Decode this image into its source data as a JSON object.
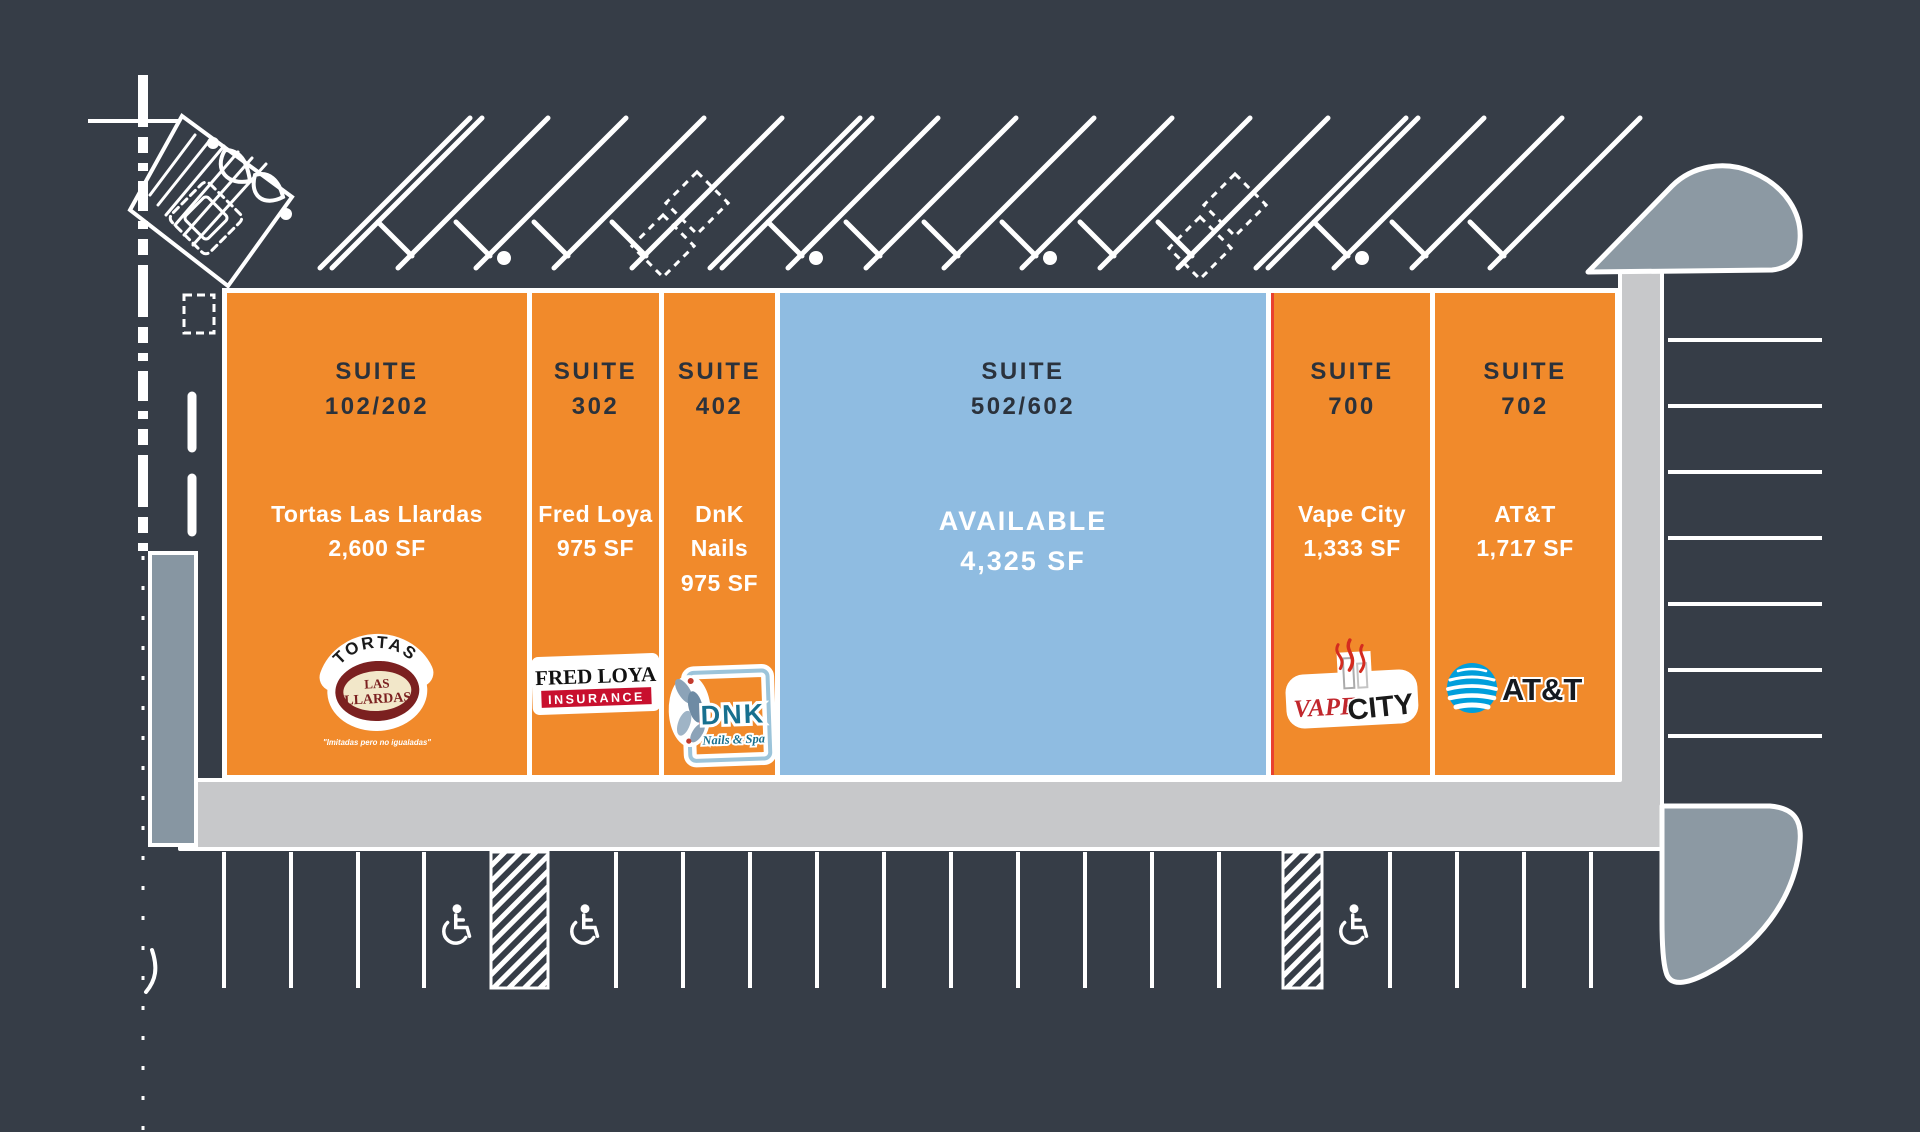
{
  "labels": {
    "suite": "SUITE"
  },
  "suites": [
    {
      "number": "102/202",
      "tenant": "Tortas Las Llardas",
      "area": "2,600 SF",
      "status": "leased"
    },
    {
      "number": "302",
      "tenant": "Fred Loya",
      "area": "975 SF",
      "status": "leased"
    },
    {
      "number": "402",
      "tenant": "DnK Nails",
      "area": "975 SF",
      "status": "leased"
    },
    {
      "number": "502/602",
      "tenant": "AVAILABLE",
      "area": "4,325 SF",
      "status": "available"
    },
    {
      "number": "700",
      "tenant": "Vape City",
      "area": "1,333 SF",
      "status": "leased"
    },
    {
      "number": "702",
      "tenant": "AT&T",
      "area": "1,717 SF",
      "status": "leased"
    }
  ],
  "logos": {
    "tortas": {
      "top": "TORTAS",
      "line1": "LAS",
      "line2": "LLARDAS",
      "tagline": "\"Imitadas pero no igualadas\""
    },
    "fred_loya": {
      "name": "FRED LOYA",
      "sub": "INSURANCE"
    },
    "dnk": {
      "name": "DNK",
      "sub": "Nails & Spa"
    },
    "vape": {
      "word1": "VAPE",
      "word2": "CITY"
    },
    "att": {
      "name": "AT&T"
    }
  },
  "colors": {
    "background": "#363D47",
    "leased_fill": "#F18A2B",
    "available_fill": "#8FBCE1",
    "suite_number_text": "#2B323C",
    "tenant_text": "#FFFFFF",
    "linework": "#FFFFFF",
    "sidewalk": "#C7C8CA",
    "landscape": "#8796A2",
    "demising_line": "#E8412F"
  }
}
